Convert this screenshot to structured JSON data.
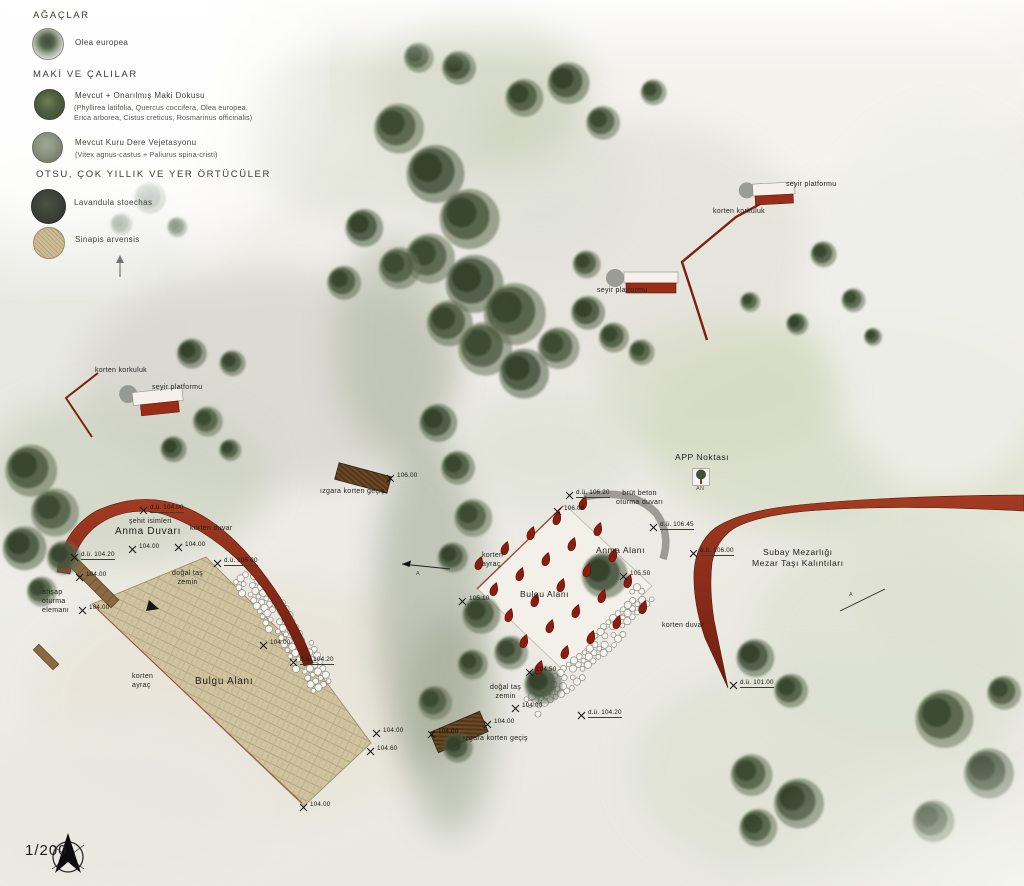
{
  "scale_label": "1/200",
  "colors": {
    "corten": "#8c2a17",
    "corten_dark": "#6e1f10",
    "drop_red": "#8c1c0d",
    "field_tan": "#cfc3a0",
    "wood": "#8a6a42",
    "concrete_grey": "#9c9c94",
    "ink": "#23231f"
  },
  "legend": {
    "sections": [
      {
        "heading": "AĞAÇLAR",
        "items": [
          {
            "label": "Olea europea",
            "sub": "",
            "swatch": "tree-icon"
          }
        ]
      },
      {
        "heading": "MAKİ VE ÇALILAR",
        "items": [
          {
            "label": "Mevcut + Onarılmış Maki Dokusu",
            "sub": "(Phyllirea latifolia, Quercus coccifera, Olea europea. Erica arborea, Cistus creticus, Rosmarinus officinalis)",
            "swatch": "maki-icon"
          },
          {
            "label": "Mevcut Kuru Dere Vejetasyonu",
            "sub": "(Vitex agnus-castus + Paliurus spina-cristi)",
            "swatch": "dry-stream-icon"
          }
        ]
      },
      {
        "heading": "OTSU, ÇOK YILLIK VE YER ÖRTÜCÜLER",
        "items": [
          {
            "label": "Lavandula stoechas",
            "sub": "",
            "swatch": "lavandula-icon"
          },
          {
            "label": "Sinapis arvensis",
            "sub": "",
            "swatch": "sinapis-icon"
          }
        ]
      }
    ]
  },
  "map": {
    "labels": [
      {
        "n": "label-seyir-platformu-1",
        "t": "seyir platformu",
        "x": 786,
        "y": 180,
        "c": "s"
      },
      {
        "n": "label-korten-korkuluk-1",
        "t": "korten korkuluk",
        "x": 713,
        "y": 207,
        "c": "s"
      },
      {
        "n": "label-seyir-platformu-2",
        "t": "seyir platformu",
        "x": 597,
        "y": 286,
        "c": "s"
      },
      {
        "n": "label-korten-korkuluk-2",
        "t": "korten korkuluk",
        "x": 95,
        "y": 366,
        "c": "s"
      },
      {
        "n": "label-seyir-platformu-3",
        "t": "seyir platformu",
        "x": 152,
        "y": 383,
        "c": "s"
      },
      {
        "n": "label-app-noktasi",
        "t": "APP Noktası",
        "x": 675,
        "y": 452,
        "c": "m"
      },
      {
        "n": "label-an",
        "t": "AN",
        "x": 696,
        "y": 486,
        "c": "xs"
      },
      {
        "n": "label-izgara-korten-gecis-1",
        "t": "ızgara korten geçiş",
        "x": 320,
        "y": 487,
        "c": "s"
      },
      {
        "n": "label-sehit-isimleri",
        "t": "şehit isimleri",
        "x": 129,
        "y": 517,
        "c": "s"
      },
      {
        "n": "label-anma-duvari",
        "t": "Anma Duvarı",
        "x": 115,
        "y": 525,
        "c": "l"
      },
      {
        "n": "label-korten-duvar-1",
        "t": "korten duvar",
        "x": 190,
        "y": 524,
        "c": "s"
      },
      {
        "n": "label-dogal-tas-zemin-1",
        "t": "doğal taş\nzemin",
        "x": 172,
        "y": 569,
        "c": "s ctr"
      },
      {
        "n": "label-ahsap-oturma-elemani",
        "t": "ahşap\noturma\nelemanı",
        "x": 42,
        "y": 588,
        "c": "s"
      },
      {
        "n": "label-korten-ayrac-1",
        "t": "korten\nayraç",
        "x": 132,
        "y": 672,
        "c": "s"
      },
      {
        "n": "label-bulgu-alani-1",
        "t": "Bulgu Alanı",
        "x": 195,
        "y": 675,
        "c": "l"
      },
      {
        "n": "label-brut-beton-oturma-duvari",
        "t": "brüt beton\noturma duvarı",
        "x": 616,
        "y": 489,
        "c": "s ctr"
      },
      {
        "n": "label-anma-alani",
        "t": "Anma Alanı",
        "x": 596,
        "y": 545,
        "c": "m"
      },
      {
        "n": "label-korten-ayrac-2",
        "t": "korten\nayraç",
        "x": 482,
        "y": 551,
        "c": "s"
      },
      {
        "n": "label-bulgu-alani-2",
        "t": "Bulgu Alanı",
        "x": 520,
        "y": 589,
        "c": "m"
      },
      {
        "n": "label-subay-mezarligi",
        "t": "Subay Mezarlığı\nMezar Taşı Kalıntıları",
        "x": 752,
        "y": 547,
        "c": "m ctr"
      },
      {
        "n": "label-korten-duvar-2",
        "t": "korten duvar",
        "x": 662,
        "y": 621,
        "c": "s"
      },
      {
        "n": "label-dogal-tas-zemin-2",
        "t": "doğal taş\nzemin",
        "x": 490,
        "y": 683,
        "c": "s ctr"
      },
      {
        "n": "label-izgara-korten-gecis-2",
        "t": "ızgara korten geçiş",
        "x": 463,
        "y": 734,
        "c": "s"
      },
      {
        "n": "label-scale",
        "t": "1/200",
        "x": 25,
        "y": 841,
        "c": "scale"
      },
      {
        "n": "label-section-a-1",
        "t": "A",
        "x": 416,
        "y": 571,
        "c": "xs"
      },
      {
        "n": "label-section-a-2",
        "t": "A",
        "x": 849,
        "y": 592,
        "c": "xs"
      }
    ],
    "elevation_markers": [
      {
        "t": "d.ü. 104.00",
        "x": 143,
        "y": 510
      },
      {
        "t": "104.00",
        "x": 132,
        "y": 549
      },
      {
        "t": "104.00",
        "x": 178,
        "y": 547
      },
      {
        "t": "d.ü. 104.20",
        "x": 74,
        "y": 557
      },
      {
        "t": "d.ü. 105.00",
        "x": 217,
        "y": 563
      },
      {
        "t": "104.00",
        "x": 79,
        "y": 577
      },
      {
        "t": "104.00",
        "x": 82,
        "y": 610
      },
      {
        "t": "104.00",
        "x": 263,
        "y": 645
      },
      {
        "t": "d.ü. 104.20",
        "x": 293,
        "y": 662
      },
      {
        "t": "104.00",
        "x": 303,
        "y": 807
      },
      {
        "t": "104.00",
        "x": 376,
        "y": 733
      },
      {
        "t": "104.60",
        "x": 370,
        "y": 751
      },
      {
        "t": "104.00",
        "x": 431,
        "y": 734
      },
      {
        "t": "104.00",
        "x": 487,
        "y": 724
      },
      {
        "t": "104.00",
        "x": 515,
        "y": 708
      },
      {
        "t": "106.00",
        "x": 390,
        "y": 478
      },
      {
        "t": "d.ü. 106.20",
        "x": 569,
        "y": 495
      },
      {
        "t": "106.00",
        "x": 557,
        "y": 511
      },
      {
        "t": "d.ü. 106.45",
        "x": 653,
        "y": 527
      },
      {
        "t": "105.50",
        "x": 623,
        "y": 576
      },
      {
        "t": "105.10",
        "x": 462,
        "y": 601
      },
      {
        "t": "d.ü. 106.00",
        "x": 693,
        "y": 553
      },
      {
        "t": "d.ü. 101.00",
        "x": 733,
        "y": 685
      },
      {
        "t": "d.ü. 104.20",
        "x": 581,
        "y": 715
      },
      {
        "t": "104.50",
        "x": 529,
        "y": 672
      }
    ],
    "washes": [
      [
        140,
        110,
        240,
        120,
        "#f8f7f3",
        0.95
      ],
      [
        690,
        80,
        360,
        110,
        "#f4f3ee",
        0.95
      ],
      [
        60,
        300,
        130,
        150,
        "#e6e7df",
        0.85
      ],
      [
        270,
        380,
        190,
        110,
        "#d7d6cf",
        0.8
      ],
      [
        640,
        250,
        170,
        130,
        "#e5e4dd",
        0.9
      ],
      [
        520,
        180,
        110,
        80,
        "#dfe1d6",
        0.7
      ],
      [
        120,
        480,
        150,
        85,
        "#ccd2bf",
        0.7
      ],
      [
        850,
        430,
        210,
        110,
        "#d8ddc8",
        0.8
      ],
      [
        980,
        560,
        120,
        140,
        "#e2e5d4",
        0.7
      ],
      [
        900,
        640,
        150,
        110,
        "#dde1d0",
        0.7
      ],
      [
        240,
        700,
        210,
        130,
        "#e9e5da",
        0.85
      ],
      [
        480,
        90,
        110,
        80,
        "#c6cdb4",
        0.6
      ],
      [
        430,
        600,
        55,
        170,
        "#8f9a82",
        0.45
      ],
      [
        450,
        725,
        45,
        110,
        "#97a189",
        0.45
      ],
      [
        395,
        345,
        60,
        110,
        "#abb49b",
        0.5
      ],
      [
        940,
        300,
        130,
        190,
        "#eff0e9",
        0.85
      ],
      [
        545,
        450,
        95,
        65,
        "#dfe2d6",
        0.7
      ],
      [
        820,
        770,
        190,
        110,
        "#dce0d0",
        0.65
      ],
      [
        120,
        800,
        150,
        80,
        "#e8e8e0",
        0.8
      ],
      [
        360,
        130,
        120,
        90,
        "#dde0d2",
        0.6
      ],
      [
        720,
        390,
        120,
        70,
        "#d4dac2",
        0.6
      ]
    ],
    "trees": [
      [
        148,
        196,
        16
      ],
      [
        120,
        223,
        11
      ],
      [
        176,
        226,
        10
      ],
      [
        28,
        468,
        26
      ],
      [
        52,
        510,
        24
      ],
      [
        22,
        546,
        22
      ],
      [
        62,
        556,
        17
      ],
      [
        40,
        590,
        15
      ],
      [
        190,
        352,
        15
      ],
      [
        231,
        362,
        13
      ],
      [
        206,
        420,
        15
      ],
      [
        172,
        448,
        13
      ],
      [
        229,
        449,
        11
      ],
      [
        396,
        126,
        25
      ],
      [
        432,
        171,
        29
      ],
      [
        466,
        216,
        30
      ],
      [
        427,
        256,
        25
      ],
      [
        471,
        281,
        29
      ],
      [
        511,
        311,
        31
      ],
      [
        482,
        346,
        27
      ],
      [
        521,
        371,
        25
      ],
      [
        447,
        321,
        23
      ],
      [
        397,
        266,
        21
      ],
      [
        362,
        226,
        19
      ],
      [
        342,
        281,
        17
      ],
      [
        556,
        346,
        21
      ],
      [
        586,
        311,
        17
      ],
      [
        612,
        336,
        15
      ],
      [
        640,
        351,
        13
      ],
      [
        566,
        81,
        21
      ],
      [
        522,
        96,
        19
      ],
      [
        601,
        121,
        17
      ],
      [
        457,
        66,
        17
      ],
      [
        417,
        56,
        15
      ],
      [
        652,
        91,
        13
      ],
      [
        436,
        421,
        19
      ],
      [
        456,
        466,
        17
      ],
      [
        471,
        516,
        19
      ],
      [
        451,
        556,
        15
      ],
      [
        479,
        613,
        19
      ],
      [
        509,
        651,
        17
      ],
      [
        541,
        683,
        19
      ],
      [
        471,
        663,
        15
      ],
      [
        433,
        701,
        17
      ],
      [
        456,
        746,
        15
      ],
      [
        822,
        253,
        13
      ],
      [
        852,
        299,
        12
      ],
      [
        796,
        323,
        11
      ],
      [
        872,
        336,
        9
      ],
      [
        749,
        301,
        10
      ],
      [
        753,
        656,
        19
      ],
      [
        789,
        689,
        17
      ],
      [
        749,
        773,
        21
      ],
      [
        796,
        801,
        25
      ],
      [
        756,
        826,
        19
      ],
      [
        941,
        716,
        29
      ],
      [
        986,
        771,
        25
      ],
      [
        931,
        819,
        21
      ],
      [
        1002,
        691,
        17
      ],
      [
        602,
        573,
        23
      ],
      [
        585,
        263,
        14
      ]
    ],
    "memorial_drops": {
      "cx": 561,
      "cy": 586,
      "rows": 5,
      "cols": 5,
      "du": [
        26,
        -15
      ],
      "dv": [
        15,
        26
      ]
    },
    "stone_paths": [
      {
        "pts": [
          [
            245,
            575
          ],
          [
            272,
            610
          ],
          [
            300,
            650
          ],
          [
            326,
            691
          ]
        ],
        "lanes": 4,
        "gap": 7
      },
      {
        "pts": [
          [
            644,
            593
          ],
          [
            607,
            638
          ],
          [
            566,
            680
          ],
          [
            527,
            710
          ]
        ],
        "lanes": 3,
        "gap": 7
      }
    ]
  }
}
